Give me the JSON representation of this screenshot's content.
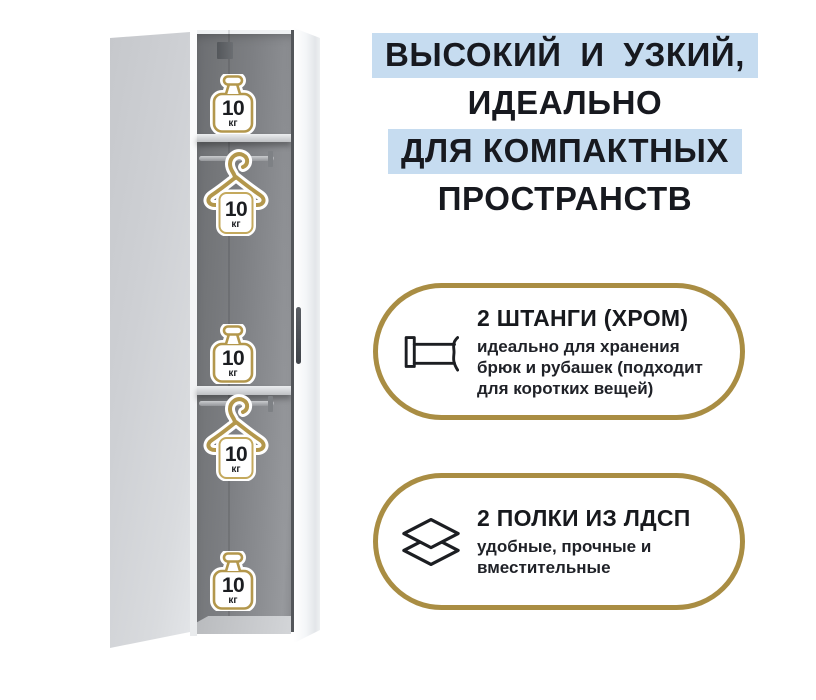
{
  "headline": {
    "lines": [
      {
        "text": "ВЫСОКИЙ И УЗКИЙ,",
        "highlighted": true
      },
      {
        "text": "ИДЕАЛЬНО",
        "highlighted": false
      },
      {
        "text": "ДЛЯ КОМПАКТНЫХ",
        "highlighted": true
      },
      {
        "text": "ПРОСТРАНСТВ",
        "highlighted": false
      }
    ],
    "highlight_color": "#c6dcf0",
    "text_color": "#17191f"
  },
  "features": [
    {
      "icon": "clothes-rail-icon",
      "title": "2 ШТАНГИ (ХРОМ)",
      "description": "идеально для хранения\nбрюк и рубашек (подходит\nдля коротких вещей)"
    },
    {
      "icon": "stacked-shelves-icon",
      "title": "2 ПОЛКИ ИЗ ЛДСП",
      "description": "удобные, прочные и\nвместительные"
    }
  ],
  "accent_color": "#a98d43",
  "gold_icon_color": "#b3974c",
  "wardrobe": {
    "capacity_badges": [
      {
        "icon": "weight-icon",
        "value": "10",
        "unit": "кг"
      },
      {
        "icon": "hanger-icon",
        "value": "10",
        "unit": "кг"
      },
      {
        "icon": "weight-icon",
        "value": "10",
        "unit": "кг"
      },
      {
        "icon": "hanger-icon",
        "value": "10",
        "unit": "кг"
      },
      {
        "icon": "weight-icon",
        "value": "10",
        "unit": "кг"
      }
    ]
  }
}
